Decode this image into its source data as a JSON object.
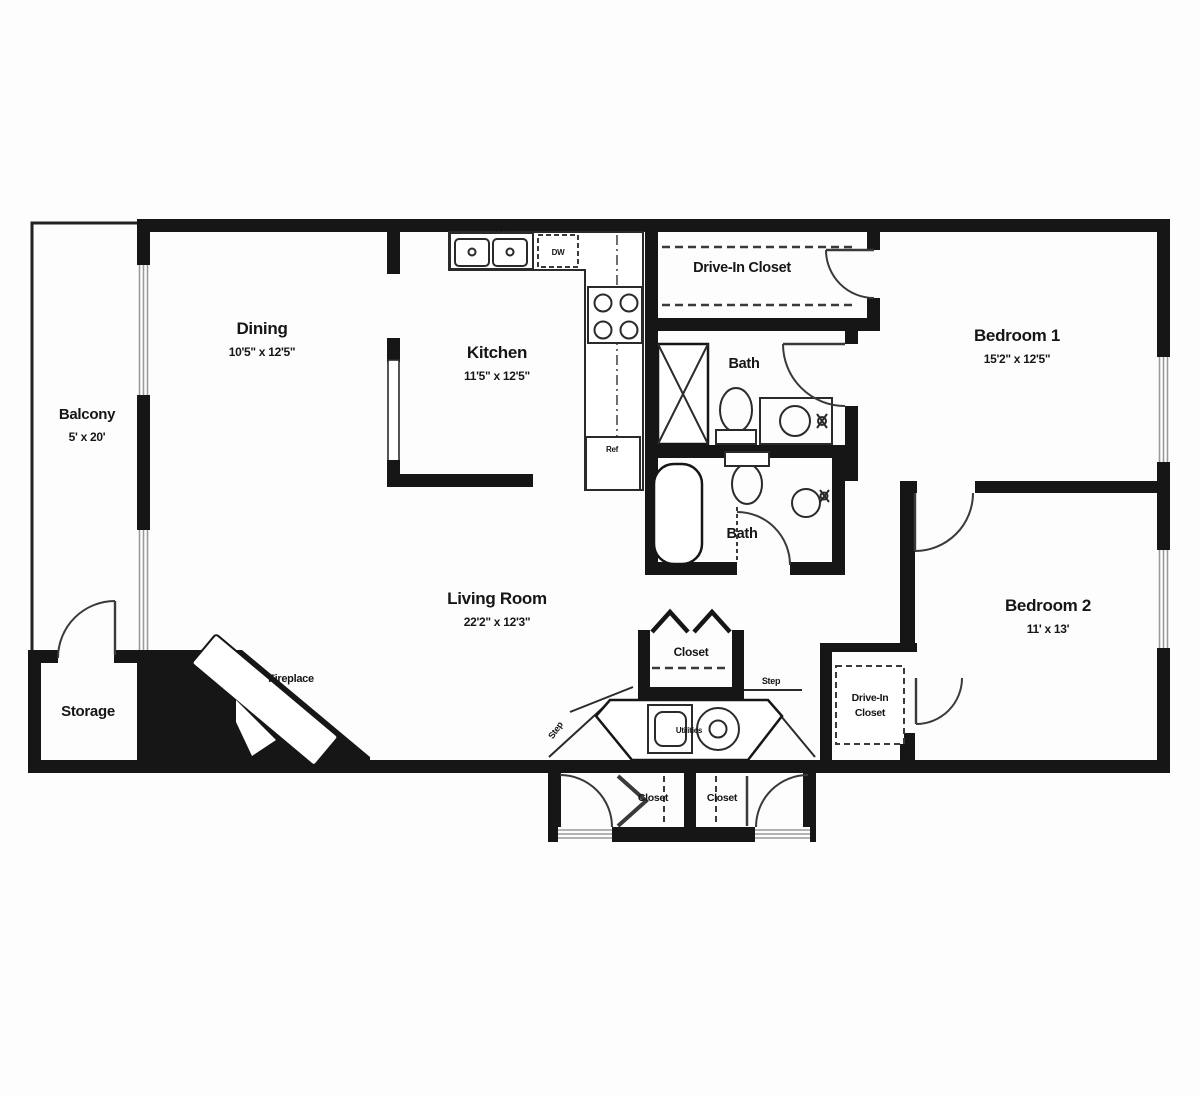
{
  "title": "Two bedroom apartment floor plan",
  "colors": {
    "wall": "#161616",
    "fixture_line": "#2a2a2a",
    "window_sill": "#9a9a9a",
    "background": "#ffffff"
  },
  "labels": {
    "balcony": "Balcony",
    "balcony_dims": "5' x 20'",
    "dining": "Dining",
    "dining_dims": "10'5\" x 12'5\"",
    "kitchen": "Kitchen",
    "kitchen_dims": "11'5\" x 12'5\"",
    "drive_in_closet_top": "Drive-In Closet",
    "bedroom1": "Bedroom 1",
    "bedroom1_dims": "15'2\" x 12'5\"",
    "bath_upper": "Bath",
    "bath_lower": "Bath",
    "living": "Living Room",
    "living_dims": "22'2\" x 12'3\"",
    "bedroom2": "Bedroom 2",
    "bedroom2_dims": "11' x 13'",
    "storage": "Storage",
    "fireplace": "Fireplace",
    "closet_center": "Closet",
    "closet_left": "Closet",
    "closet_right": "Closet",
    "drive_in2_line1": "Drive-In",
    "drive_in2_line2": "Closet",
    "step_left": "Step",
    "step_right": "Step",
    "utilities": "Utilities",
    "dw": "DW",
    "ref": "Ref"
  }
}
